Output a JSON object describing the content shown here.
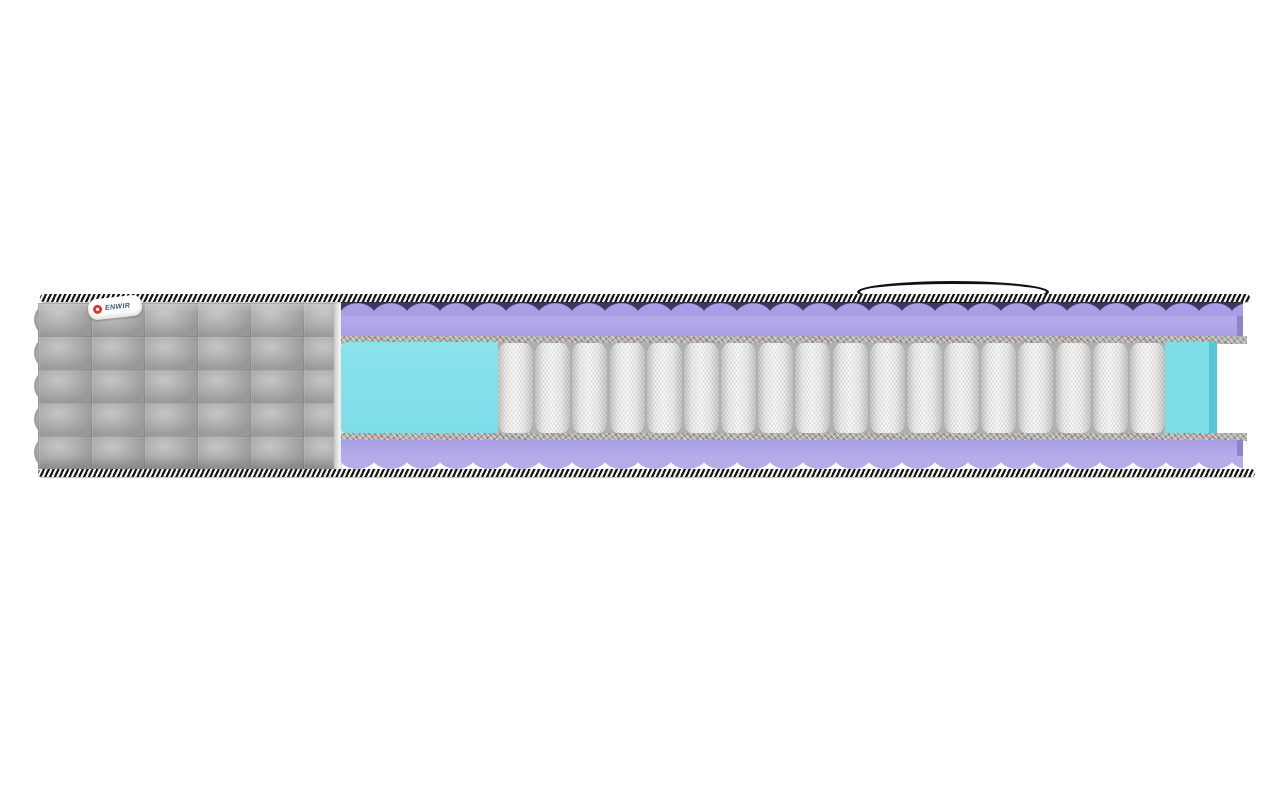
{
  "meta": {
    "description": "Cutaway product render of a pocket-spring mattress on a white background"
  },
  "label": {
    "brand": "ENWIR"
  },
  "springs": {
    "count": 18
  },
  "colors": {
    "fabric_gray": "#adadab",
    "fabric_highlight": "#c6c6c4",
    "fabric_shadow": "#989896",
    "tape_black": "#161616",
    "tape_white": "#f4f4f2",
    "foam_purple": "#a79ee3",
    "foam_purple_light": "#b5adea",
    "foam_purple_dark": "#8d85c8",
    "wave_shadow_navy": "#3d3863",
    "foam_cyan": "#7edde9",
    "foam_cyan_light": "#8ae2ec",
    "foam_cyan_side": "#58c6d6",
    "felt_gray": "#b3b1ad",
    "spring_white": "#fbfbf9",
    "spring_shade": "#c7c7c5",
    "spring_gap": "#b0b0ae",
    "handle_black": "#111111",
    "logo_red": "#d93a30",
    "label_text": "#3c4f73"
  }
}
